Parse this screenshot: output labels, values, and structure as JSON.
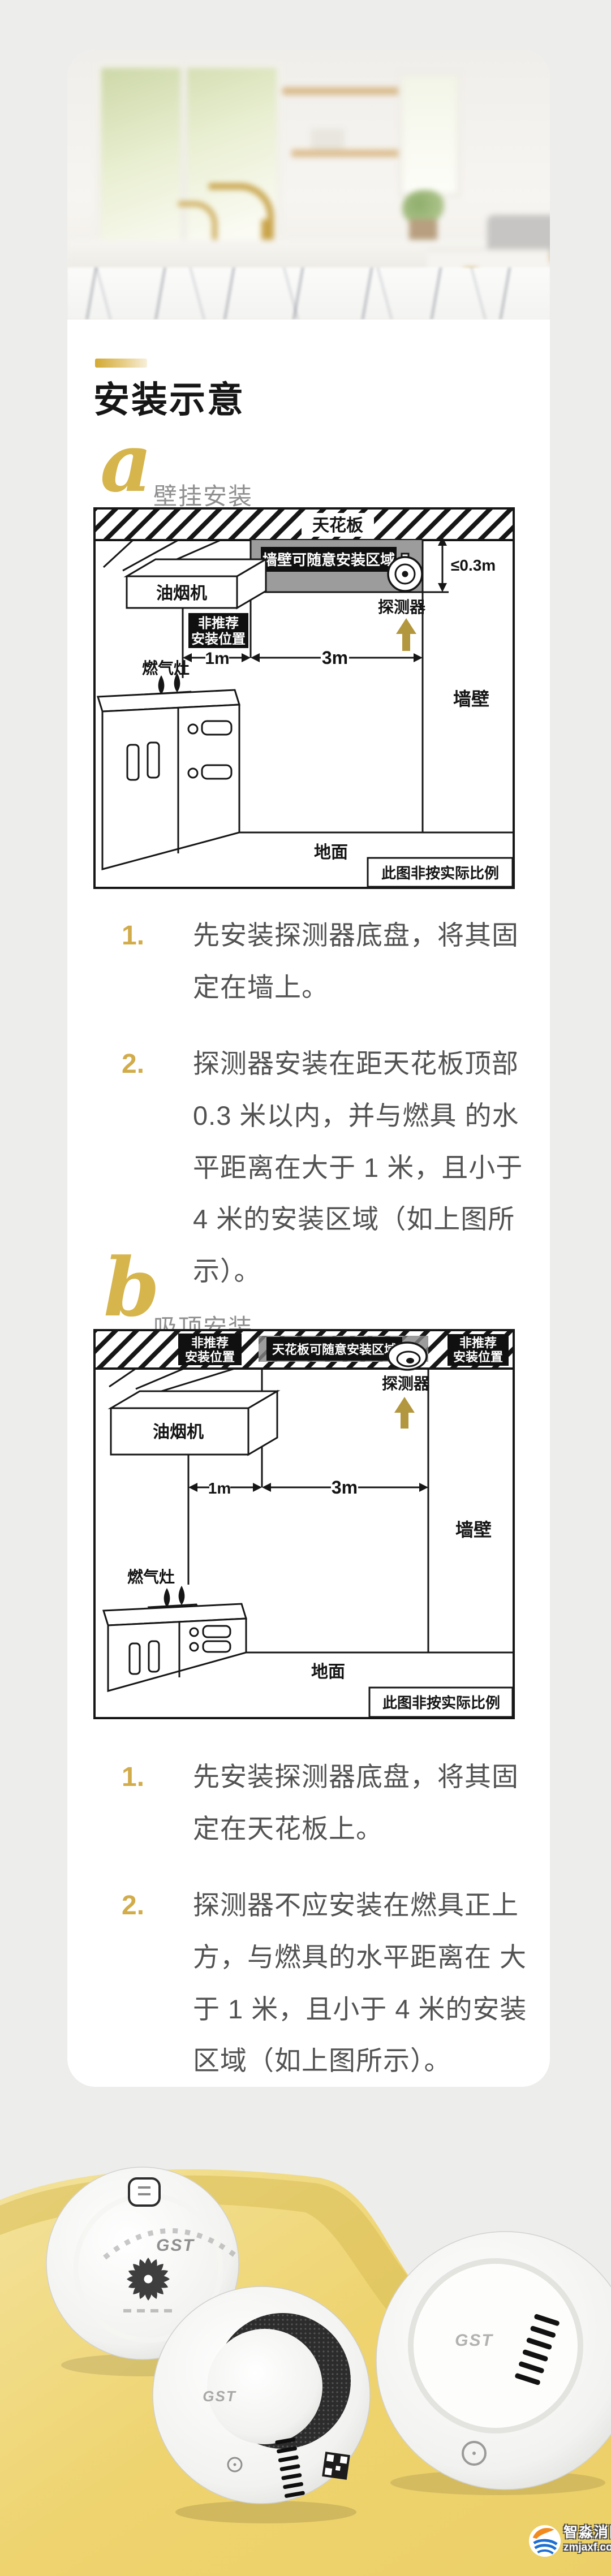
{
  "header": {
    "title": "安装示意"
  },
  "sections": {
    "a": {
      "letter": "a",
      "label": "壁挂安装",
      "items": [
        {
          "num": "1.",
          "text": "先安装探测器底盘，将其固定在墙上。"
        },
        {
          "num": "2.",
          "text": "探测器安装在距天花板顶部 0.3 米以内，并与燃具 的水平距离在大于 1 米，且小于 4 米的安装区域（如上图所示）。"
        }
      ]
    },
    "b": {
      "letter": "b",
      "label": "吸顶安装",
      "items": [
        {
          "num": "1.",
          "text": "先安装探测器底盘，将其固定在天花板上。"
        },
        {
          "num": "2.",
          "text": "探测器不应安装在燃具正上方，与燃具的水平距离在 大于 1 米，且小于 4 米的安装区域（如上图所示）。"
        }
      ]
    }
  },
  "diagram_a": {
    "ceiling": "天花板",
    "zone": "墙壁可随意安装区域",
    "height_limit": "≤0.3m",
    "detector": "探测器",
    "hood": "油烟机",
    "not_recommended_line1": "非推荐",
    "not_recommended_line2": "安装位置",
    "dim_1": "1m",
    "dim_2": "3m",
    "stove": "燃气灶",
    "wall": "墙壁",
    "ground": "地面",
    "scale_note": "此图非按实际比例"
  },
  "diagram_b": {
    "ceiling_zone": "天花板可随意安装区域",
    "not_recommended_line1": "非推荐",
    "not_recommended_line2": "安装位置",
    "detector": "探测器",
    "hood": "油烟机",
    "dim_1": "1m",
    "dim_2": "3m",
    "stove": "燃气灶",
    "wall": "墙壁",
    "ground": "地面",
    "scale_note": "此图非按实际比例"
  },
  "products": {
    "brand": "GST"
  },
  "watermark": {
    "name": "智淼消防",
    "site": "zmjaxf.com"
  },
  "colors": {
    "accent_gold": "#d2ac4a",
    "arrow_gold": "#b3973e",
    "yellow": "#eed36e",
    "zone_gray": "#9c9c9c"
  }
}
